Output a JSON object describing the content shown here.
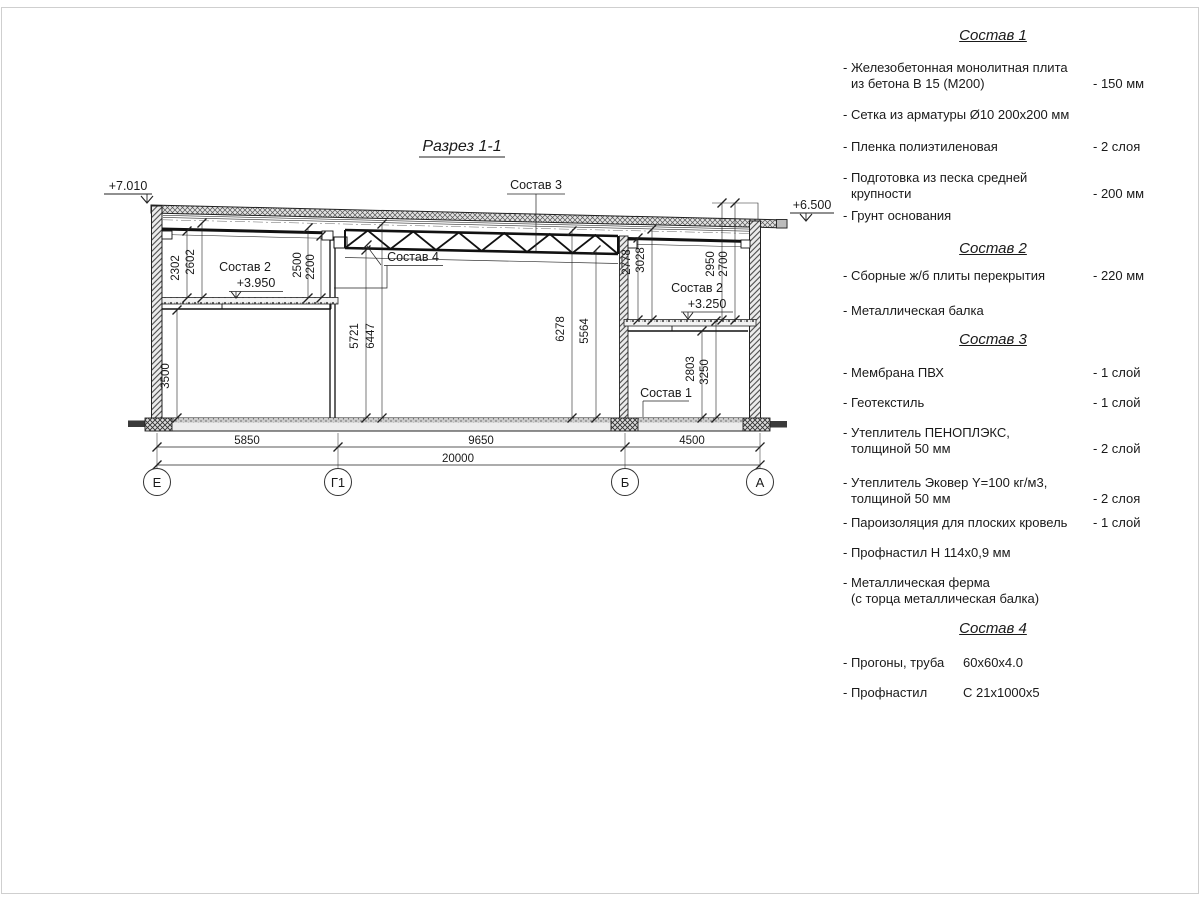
{
  "page": {
    "title": "Разрез 1-1"
  },
  "drawing": {
    "elevation_marks": {
      "top_left": "+7.010",
      "top_right": "+6.500"
    },
    "level_marks": {
      "left": "+3.950",
      "right": "+3.250"
    },
    "callouts": {
      "sostav1": "Состав 1",
      "sostav2_left": "Состав 2",
      "sostav2_right": "Состав 2",
      "sostav3": "Состав 3",
      "sostav4": "Состав 4"
    },
    "dims": {
      "d2302": "2302",
      "d2602": "2602",
      "d2500": "2500",
      "d2200": "2200",
      "d3500": "3500",
      "d5721": "5721",
      "d6447": "6447",
      "d6278": "6278",
      "d5564": "5564",
      "d2778": "2778",
      "d3028": "3028",
      "d2950": "2950",
      "d2700": "2700",
      "d2803": "2803",
      "d3250": "3250",
      "b5850": "5850",
      "b9650": "9650",
      "b4500": "4500",
      "b20000": "20000"
    },
    "axes": {
      "e": "Е",
      "g1": "Г1",
      "b": "Б",
      "a": "А"
    }
  },
  "legend": {
    "sections": [
      {
        "title": "Состав 1",
        "items": [
          {
            "lines": [
              "- Железобетонная  монолитная плита",
              "из бетона В 15 (М200)"
            ],
            "value": "- 150 мм"
          },
          {
            "lines": [
              "- Сетка из арматуры Ø10 200х200 мм"
            ]
          },
          {
            "lines": [
              "- Пленка полиэтиленовая"
            ],
            "value": "-  2 слоя"
          },
          {
            "lines": [
              "- Подготовка из песка средней",
              "крупности"
            ],
            "value": "- 200 мм"
          },
          {
            "lines": [
              "- Грунт основания"
            ]
          }
        ]
      },
      {
        "title": "Состав 2",
        "items": [
          {
            "lines": [
              "- Сборные ж/б плиты перекрытия"
            ],
            "value": "- 220 мм"
          },
          {
            "lines": [
              "- Металлическая балка"
            ]
          }
        ]
      },
      {
        "title": "Состав 3",
        "items": [
          {
            "lines": [
              "- Мембрана ПВХ"
            ],
            "value": "- 1 слой"
          },
          {
            "lines": [
              "- Геотекстиль"
            ],
            "value": "- 1 слой"
          },
          {
            "lines": [
              "- Утеплитель ПЕНОПЛЭКС,",
              "толщиной 50 мм"
            ],
            "value": "- 2 слой"
          },
          {
            "lines": [
              "- Утеплитель Эковер Y=100 кг/м3,",
              "толщиной 50 мм"
            ],
            "value": "- 2 слоя"
          },
          {
            "lines": [
              "- Пароизоляция для плоских кровель"
            ],
            "value": "- 1 слой"
          },
          {
            "lines": [
              "- Профнастил Н 114х0,9 мм"
            ]
          },
          {
            "lines": [
              "- Металлическая ферма",
              "(с торца металлическая балка)"
            ]
          }
        ]
      },
      {
        "title": "Состав 4",
        "items": [
          {
            "lines": [
              "- Прогоны, труба"
            ],
            "value": "60х60х4.0"
          },
          {
            "lines": [
              "- Профнастил"
            ],
            "value": "С 21х1000х5"
          }
        ]
      }
    ]
  }
}
